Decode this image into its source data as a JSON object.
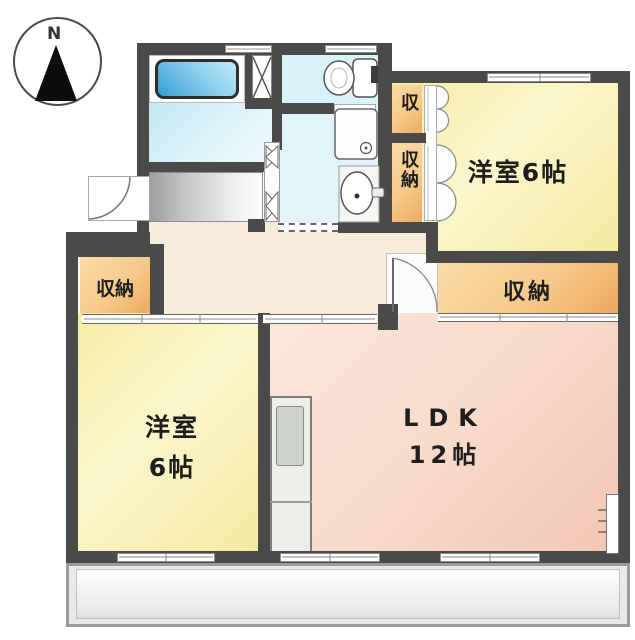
{
  "figure_type": "apartment-floor-plan",
  "compass": {
    "north_label": "N"
  },
  "rooms": {
    "bedroom_upper_right": {
      "label": "洋室6帖",
      "type": "western-room"
    },
    "bedroom_lower_left": {
      "label_line1": "洋室",
      "label_line2": "6帖",
      "type": "western-room"
    },
    "ldk": {
      "label_line1": "LDK",
      "label_line2": "12帖",
      "type": "living-dining-kitchen"
    },
    "closet_hall": {
      "label": "収納"
    },
    "closet_upper": {
      "label": "収"
    },
    "closet_middle": {
      "label": "収納"
    },
    "closet_lower_right": {
      "label": "収納"
    }
  },
  "fixtures": [
    "bathtub",
    "pipe-shaft",
    "toilet",
    "washing-machine-pan",
    "washbasin",
    "kitchen-counter",
    "balcony",
    "entrance-door",
    "compass-north-arrow"
  ],
  "colors": {
    "wall": "#4a4a48",
    "room_yellow": "#f5eba5",
    "ldk_pink": "#f8d9ca",
    "closet_orange": "#f0b873",
    "hall_cream": "#f7ecd9",
    "bath_blue": "#c3e8f3",
    "tub_blue": "#2f9ed5",
    "genkan_gray": "#b5b5b5",
    "balcony_gray": "#e9e9e9",
    "text": "#1e1e1e"
  }
}
